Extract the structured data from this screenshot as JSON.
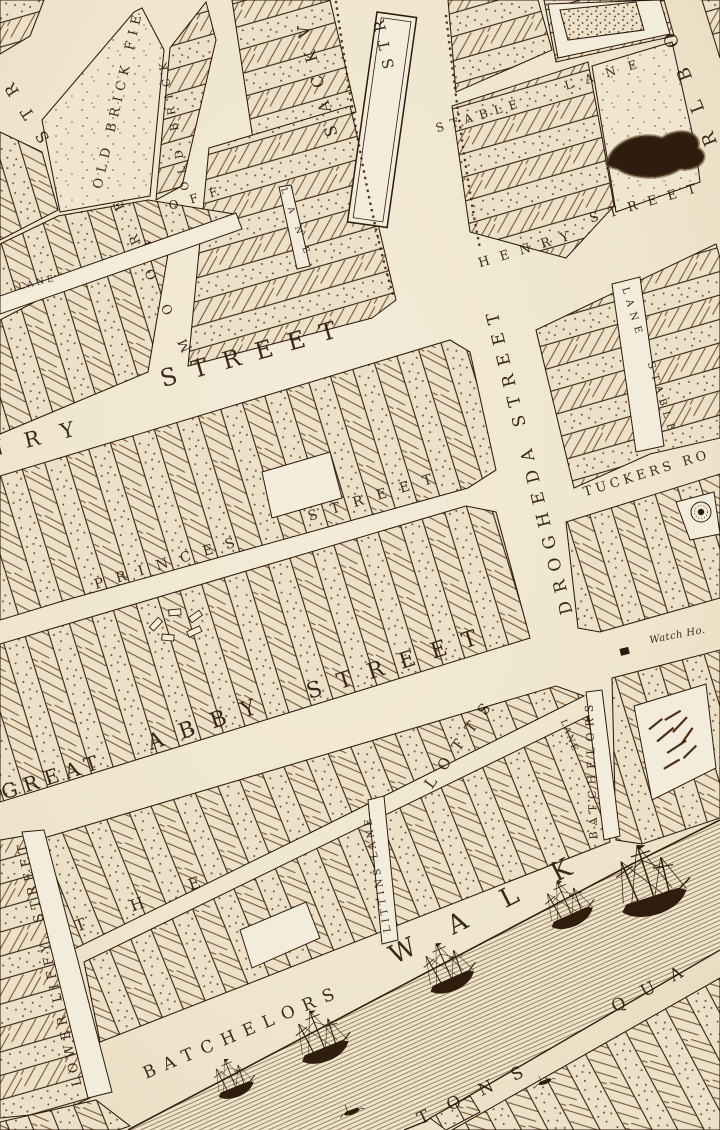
{
  "palette": {
    "paper": "#efe5cd",
    "paper_light": "#f4ecda",
    "ink": "#2c1b0d",
    "ink_mid": "#5d432a",
    "hatch_line": "#6f4e2c",
    "stipple_dot": "#4f361d",
    "water_line": "#7d6244"
  },
  "map": {
    "labels": [
      {
        "text": "STR",
        "x": 27,
        "y": 103,
        "rot": -123,
        "fs": 16,
        "ls": 17
      },
      {
        "text": "OLD BRICK FIE",
        "x": 122,
        "y": 100,
        "rot": -77,
        "fs": 13,
        "ls": 6
      },
      {
        "text": "OLD BRICK",
        "x": 177,
        "y": 122,
        "rot": -100,
        "fs": 11,
        "ls": 8
      },
      {
        "text": "OFF",
        "x": 200,
        "y": 201,
        "rot": -17,
        "fs": 12,
        "ls": 12
      },
      {
        "text": "LANE",
        "x": 38,
        "y": 285,
        "rot": -14,
        "fs": 9,
        "ls": 3
      },
      {
        "text": "MOORE",
        "x": 150,
        "y": 262,
        "rot": -115,
        "fs": 13,
        "ls": 28
      },
      {
        "text": "LANE",
        "x": 295,
        "y": 228,
        "rot": 70,
        "fs": 9,
        "ls": 14
      },
      {
        "text": "SACKV",
        "x": 321,
        "y": 73,
        "rot": -105,
        "fs": 16,
        "ls": 14
      },
      {
        "text": "STR",
        "x": 388,
        "y": 39,
        "rot": -102,
        "fs": 15,
        "ls": 9
      },
      {
        "text": "STABLE",
        "x": 481,
        "y": 119,
        "rot": -17,
        "fs": 12,
        "ls": 7
      },
      {
        "text": "LANE",
        "x": 608,
        "y": 77,
        "rot": -17,
        "fs": 12,
        "ls": 13
      },
      {
        "text": "HENRY",
        "x": 530,
        "y": 252,
        "rot": -17,
        "fs": 13,
        "ls": 11
      },
      {
        "text": "STREET",
        "x": 649,
        "y": 206,
        "rot": -16,
        "fs": 13,
        "ls": 11
      },
      {
        "text": "RLBO",
        "x": 692,
        "y": 77,
        "rot": -111,
        "fs": 18,
        "ls": 22
      },
      {
        "text": "NRY",
        "x": 42,
        "y": 444,
        "rot": -14,
        "fs": 21,
        "ls": 22
      },
      {
        "text": "STREET",
        "x": 258,
        "y": 360,
        "rot": -16,
        "fs": 24,
        "ls": 16
      },
      {
        "text": "DROGHEDA STREET",
        "x": 534,
        "y": 458,
        "rot": -104,
        "fs": 17,
        "ls": 9
      },
      {
        "text": "PRINCES",
        "x": 172,
        "y": 566,
        "rot": -17,
        "fs": 14,
        "ls": 13
      },
      {
        "text": "STREET",
        "x": 378,
        "y": 500,
        "rot": -17,
        "fs": 14,
        "ls": 14
      },
      {
        "text": "TUCKERS RO",
        "x": 648,
        "y": 477,
        "rot": -17,
        "fs": 13,
        "ls": 4
      },
      {
        "text": "LANE",
        "x": 630,
        "y": 314,
        "rot": 73,
        "fs": 10,
        "ls": 6
      },
      {
        "text": "STABLE",
        "x": 659,
        "y": 400,
        "rot": 73,
        "fs": 10,
        "ls": 6
      },
      {
        "text": "GREAT",
        "x": 55,
        "y": 783,
        "rot": -18,
        "fs": 20,
        "ls": 7
      },
      {
        "text": "ABBY",
        "x": 212,
        "y": 729,
        "rot": -19,
        "fs": 22,
        "ls": 17
      },
      {
        "text": "STREET",
        "x": 402,
        "y": 669,
        "rot": -18,
        "fs": 22,
        "ls": 17
      },
      {
        "text": "Watch Ho.",
        "x": 678,
        "y": 638,
        "rot": -11,
        "fs": 10,
        "ls": 0.5,
        "cls": "it"
      },
      {
        "text": "LANE",
        "x": 567,
        "y": 737,
        "rot": 68,
        "fs": 9,
        "ls": 2
      },
      {
        "text": "BATCHELORS",
        "x": 595,
        "y": 769,
        "rot": -92,
        "fs": 11,
        "ls": 6
      },
      {
        "text": "THE",
        "x": 162,
        "y": 901,
        "rot": -20,
        "fs": 16,
        "ls": 48
      },
      {
        "text": "LOTTS",
        "x": 465,
        "y": 744,
        "rot": -54,
        "fs": 15,
        "ls": 12
      },
      {
        "text": "LITTINS LANE.",
        "x": 380,
        "y": 870,
        "rot": -100,
        "fs": 10,
        "ls": 3.5
      },
      {
        "text": "LOWER LIFFY. STREET",
        "x": 53,
        "y": 962,
        "rot": -103,
        "fs": 13,
        "ls": 5
      },
      {
        "text": "BATCHELORS",
        "x": 245,
        "y": 1037,
        "rot": -23,
        "fs": 17,
        "ls": 9
      },
      {
        "text": "WALK",
        "x": 502,
        "y": 910,
        "rot": -27,
        "fs": 26,
        "ls": 40
      },
      {
        "text": "TONS",
        "x": 482,
        "y": 1096,
        "rot": -25,
        "fs": 17,
        "ls": 21
      },
      {
        "text": "QUA",
        "x": 658,
        "y": 990,
        "rot": -28,
        "fs": 17,
        "ls": 19
      }
    ]
  }
}
